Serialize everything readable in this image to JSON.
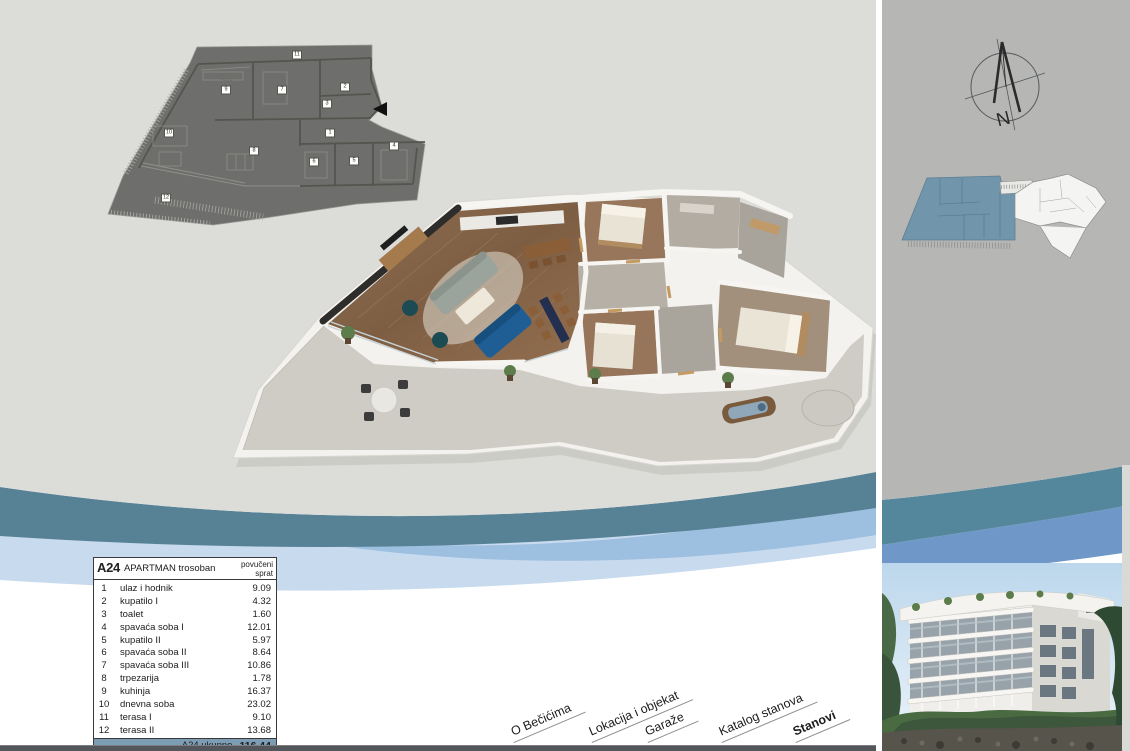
{
  "nav": {
    "items": [
      {
        "label": "O Bečićima",
        "active": false
      },
      {
        "label": "Lokacija i objekat",
        "active": false
      },
      {
        "label": "Garaže",
        "active": false
      },
      {
        "label": "Katalog stanova",
        "active": false
      },
      {
        "label": "Stanovi",
        "active": true
      }
    ]
  },
  "area_table": {
    "unit": "A24",
    "type_label": "APARTMAN trosoban",
    "column_header_line1": "povučeni",
    "column_header_line2": "sprat",
    "rows": [
      [
        "1",
        "ulaz i hodnik",
        "9.09"
      ],
      [
        "2",
        "kupatilo I",
        "4.32"
      ],
      [
        "3",
        "toalet",
        "1.60"
      ],
      [
        "4",
        "spavaća soba I",
        "12.01"
      ],
      [
        "5",
        "kupatilo II",
        "5.97"
      ],
      [
        "6",
        "spavaća soba II",
        "8.64"
      ],
      [
        "7",
        "spavaća soba III",
        "10.86"
      ],
      [
        "8",
        "trpezarija",
        "1.78"
      ],
      [
        "9",
        "kuhinja",
        "16.37"
      ],
      [
        "10",
        "dnevna soba",
        "23.02"
      ],
      [
        "11",
        "terasa I",
        "9.10"
      ],
      [
        "12",
        "terasa II",
        "13.68"
      ]
    ],
    "total_label": "A24 ukupno",
    "total_value": "116.44"
  },
  "plan2d": {
    "room_numbers": [
      "1",
      "2",
      "3",
      "4",
      "5",
      "6",
      "7",
      "8",
      "9",
      "10",
      "11",
      "12"
    ],
    "dimensions": [
      "480.5",
      "340",
      "514.5",
      "298",
      "300"
    ]
  },
  "compass": {
    "label": "N"
  },
  "colors": {
    "background_gray": "#dcdcd9",
    "panel_gray": "#b6b7b5",
    "wave_teal": "#578296",
    "wave_blue": "#6f97c8",
    "wave_pale_blue": "#c8daee",
    "table_footer_blue": "#7d9db4",
    "siteplan_highlight": "#7195ab",
    "bottom_bar": "#53565a"
  }
}
